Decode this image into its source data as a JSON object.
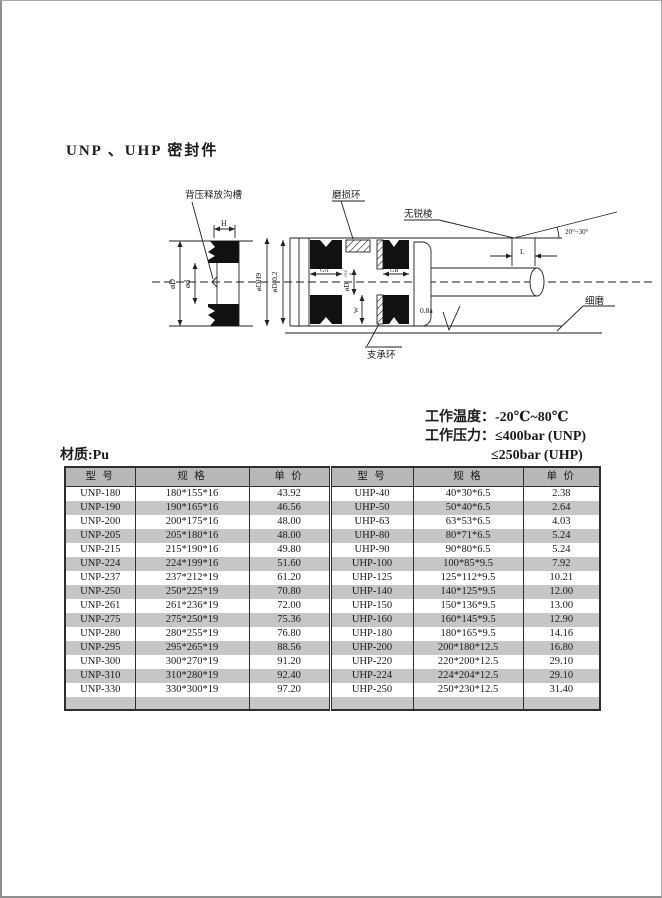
{
  "colors": {
    "header-bg": "#b8b8b8",
    "stripe": "#c6c6c6",
    "line": "#222222"
  },
  "page": {
    "title": "UNP 、UHP 密封件"
  },
  "diagram": {
    "labels": {
      "back_pressure_groove": "背压释放沟槽",
      "wear_ring": "磨损环",
      "no_sharp_edge": "无锐棱",
      "angle": "20°~30°",
      "dim_h": "H",
      "dim_l": "L",
      "dim_od": "øD",
      "dim_id": "ød",
      "dim_odh9": "øDH9",
      "dim_od_minus": "øD-0.2",
      "dim_od_bore": "øD",
      "dim_od_tol_sup": "+0.2",
      "dim_od_tol_sub": "0",
      "dim_ga": "GA",
      "dim_gb": "GB",
      "dim_w": "W",
      "roughness": "0.8a",
      "fine_grind": "细磨",
      "support_ring": "支承环"
    }
  },
  "specs": {
    "temp_label": "工作温度：",
    "temp_value": "-20℃~80℃",
    "pressure_label": "工作压力：",
    "pressure_unp": "≤400bar (UNP)",
    "pressure_uhp": "≤250bar (UHP)",
    "material": "材质:Pu"
  },
  "table": {
    "headers": [
      "型 号",
      "规 格",
      "单 价",
      "型 号",
      "规 格",
      "单 价"
    ],
    "rows": [
      [
        "UNP-180",
        "180*155*16",
        "43.92",
        "UHP-40",
        "40*30*6.5",
        "2.38"
      ],
      [
        "UNP-190",
        "190*165*16",
        "46.56",
        "UHP-50",
        "50*40*6.5",
        "2.64"
      ],
      [
        "UNP-200",
        "200*175*16",
        "48.00",
        "UHP-63",
        "63*53*6.5",
        "4.03"
      ],
      [
        "UNP-205",
        "205*180*16",
        "48.00",
        "UHP-80",
        "80*71*6.5",
        "5.24"
      ],
      [
        "UNP-215",
        "215*190*16",
        "49.80",
        "UHP-90",
        "90*80*6.5",
        "5.24"
      ],
      [
        "UNP-224",
        "224*199*16",
        "51.60",
        "UHP-100",
        "100*85*9.5",
        "7.92"
      ],
      [
        "UNP-237",
        "237*212*19",
        "61.20",
        "UHP-125",
        "125*112*9.5",
        "10.21"
      ],
      [
        "UNP-250",
        "250*225*19",
        "70.80",
        "UHP-140",
        "140*125*9.5",
        "12.00"
      ],
      [
        "UNP-261",
        "261*236*19",
        "72.00",
        "UHP-150",
        "150*136*9.5",
        "13.00"
      ],
      [
        "UNP-275",
        "275*250*19",
        "75.36",
        "UHP-160",
        "160*145*9.5",
        "12.90"
      ],
      [
        "UNP-280",
        "280*255*19",
        "76.80",
        "UHP-180",
        "180*165*9.5",
        "14.16"
      ],
      [
        "UNP-295",
        "295*265*19",
        "88.56",
        "UHP-200",
        "200*180*12.5",
        "16.80"
      ],
      [
        "UNP-300",
        "300*270*19",
        "91.20",
        "UHP-220",
        "220*200*12.5",
        "29.10"
      ],
      [
        "UNP-310",
        "310*280*19",
        "92.40",
        "UHP-224",
        "224*204*12.5",
        "29.10"
      ],
      [
        "UNP-330",
        "330*300*19",
        "97.20",
        "UHP-250",
        "250*230*12.5",
        "31.40"
      ]
    ]
  }
}
